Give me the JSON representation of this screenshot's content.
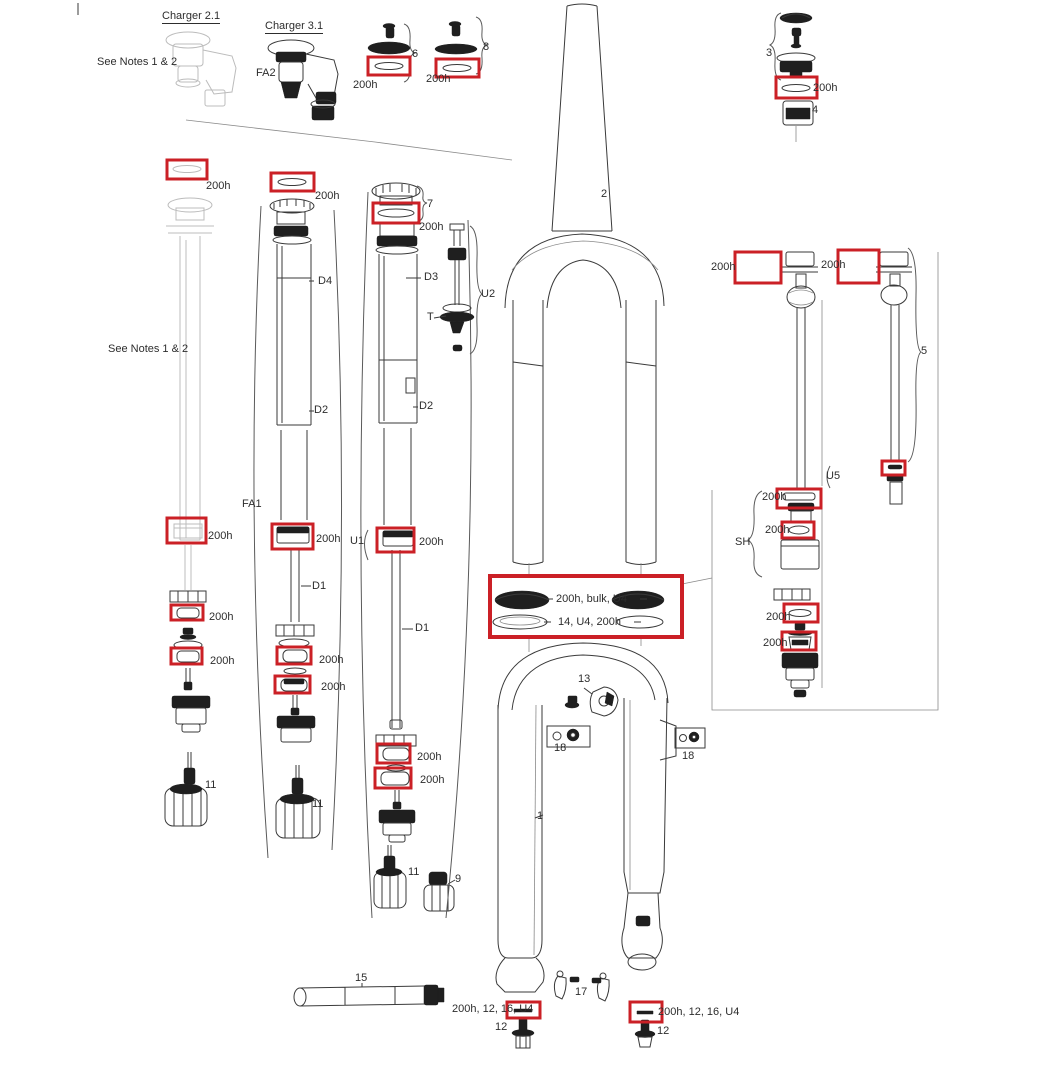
{
  "figure": {
    "type": "exploded-parts-diagram",
    "subject": "Suspension fork exploded parts view",
    "highlight_color": "#cb2026",
    "line_color": "#3a3a3a",
    "ghost_color": "#bcbcbc",
    "annotations": [
      {
        "text": "Charger 2.1",
        "x": 162,
        "y": 10,
        "underline": true
      },
      {
        "text": "Charger 3.1",
        "x": 265,
        "y": 20,
        "underline": true
      },
      {
        "text": "See Notes 1 & 2",
        "x": 97,
        "y": 56
      },
      {
        "text": "FA2",
        "x": 256,
        "y": 67
      },
      {
        "text": "6",
        "x": 412,
        "y": 48
      },
      {
        "text": "200h",
        "x": 353,
        "y": 79
      },
      {
        "text": "8",
        "x": 483,
        "y": 41
      },
      {
        "text": "200h",
        "x": 426,
        "y": 73
      },
      {
        "text": "3",
        "x": 766,
        "y": 47
      },
      {
        "text": "200h",
        "x": 813,
        "y": 82
      },
      {
        "text": "4",
        "x": 812,
        "y": 104
      },
      {
        "text": "200h",
        "x": 206,
        "y": 180
      },
      {
        "text": "200h",
        "x": 315,
        "y": 190
      },
      {
        "text": "7",
        "x": 427,
        "y": 198
      },
      {
        "text": "200h",
        "x": 419,
        "y": 221
      },
      {
        "text": "2",
        "x": 601,
        "y": 188
      },
      {
        "text": "D4",
        "x": 318,
        "y": 275
      },
      {
        "text": "D3",
        "x": 424,
        "y": 271
      },
      {
        "text": "U2",
        "x": 481,
        "y": 288
      },
      {
        "text": "T",
        "x": 427,
        "y": 311
      },
      {
        "text": "200h",
        "x": 711,
        "y": 261
      },
      {
        "text": "200h",
        "x": 821,
        "y": 259
      },
      {
        "text": "5",
        "x": 921,
        "y": 345
      },
      {
        "text": "See Notes 1 & 2",
        "x": 108,
        "y": 343
      },
      {
        "text": "D2",
        "x": 314,
        "y": 404
      },
      {
        "text": "D2",
        "x": 419,
        "y": 400
      },
      {
        "text": "FA1",
        "x": 242,
        "y": 498
      },
      {
        "text": "U5",
        "x": 826,
        "y": 470
      },
      {
        "text": "200h",
        "x": 762,
        "y": 491
      },
      {
        "text": "200h",
        "x": 765,
        "y": 524
      },
      {
        "text": "SH",
        "x": 735,
        "y": 536
      },
      {
        "text": "200h",
        "x": 208,
        "y": 530
      },
      {
        "text": "200h",
        "x": 316,
        "y": 533
      },
      {
        "text": "U1",
        "x": 350,
        "y": 535
      },
      {
        "text": "200h",
        "x": 419,
        "y": 536
      },
      {
        "text": "D1",
        "x": 312,
        "y": 580
      },
      {
        "text": "200h, bulk, U4",
        "x": 556,
        "y": 593
      },
      {
        "text": "14, U4, 200h",
        "x": 558,
        "y": 616
      },
      {
        "text": "D1",
        "x": 415,
        "y": 622
      },
      {
        "text": "200h",
        "x": 766,
        "y": 611
      },
      {
        "text": "200h",
        "x": 763,
        "y": 637
      },
      {
        "text": "200h",
        "x": 209,
        "y": 611
      },
      {
        "text": "200h",
        "x": 210,
        "y": 655
      },
      {
        "text": "200h",
        "x": 319,
        "y": 654
      },
      {
        "text": "200h",
        "x": 321,
        "y": 681
      },
      {
        "text": "13",
        "x": 578,
        "y": 673
      },
      {
        "text": "18",
        "x": 554,
        "y": 742
      },
      {
        "text": "18",
        "x": 682,
        "y": 750
      },
      {
        "text": "200h",
        "x": 417,
        "y": 751
      },
      {
        "text": "200h",
        "x": 420,
        "y": 774
      },
      {
        "text": "11",
        "x": 205,
        "y": 779
      },
      {
        "text": "11",
        "x": 312,
        "y": 798
      },
      {
        "text": "1",
        "x": 537,
        "y": 810
      },
      {
        "text": "11",
        "x": 408,
        "y": 866
      },
      {
        "text": "9",
        "x": 455,
        "y": 873
      },
      {
        "text": "15",
        "x": 355,
        "y": 972
      },
      {
        "text": "17",
        "x": 575,
        "y": 986
      },
      {
        "text": "200h, 12, 16, U4",
        "x": 452,
        "y": 1003
      },
      {
        "text": "12",
        "x": 495,
        "y": 1021
      },
      {
        "text": "200h, 12, 16, U4",
        "x": 658,
        "y": 1006
      },
      {
        "text": "12",
        "x": 657,
        "y": 1025
      }
    ],
    "highlights": [
      {
        "x": 368,
        "y": 57,
        "w": 42,
        "h": 18
      },
      {
        "x": 436,
        "y": 59,
        "w": 43,
        "h": 18
      },
      {
        "x": 776,
        "y": 77,
        "w": 41,
        "h": 21
      },
      {
        "x": 167,
        "y": 160,
        "w": 40,
        "h": 19
      },
      {
        "x": 271,
        "y": 173,
        "w": 43,
        "h": 18
      },
      {
        "x": 373,
        "y": 203,
        "w": 46,
        "h": 20
      },
      {
        "x": 735,
        "y": 252,
        "w": 46,
        "h": 31
      },
      {
        "x": 838,
        "y": 250,
        "w": 41,
        "h": 33
      },
      {
        "x": 882,
        "y": 461,
        "w": 23,
        "h": 14
      },
      {
        "x": 777,
        "y": 489,
        "w": 44,
        "h": 19
      },
      {
        "x": 782,
        "y": 522,
        "w": 32,
        "h": 16
      },
      {
        "x": 784,
        "y": 604,
        "w": 34,
        "h": 18
      },
      {
        "x": 782,
        "y": 632,
        "w": 34,
        "h": 18
      },
      {
        "x": 171,
        "y": 605,
        "w": 32,
        "h": 15
      },
      {
        "x": 171,
        "y": 648,
        "w": 31,
        "h": 16
      },
      {
        "x": 277,
        "y": 647,
        "w": 34,
        "h": 17
      },
      {
        "x": 275,
        "y": 676,
        "w": 35,
        "h": 17
      },
      {
        "x": 377,
        "y": 744,
        "w": 33,
        "h": 19
      },
      {
        "x": 375,
        "y": 768,
        "w": 36,
        "h": 20
      },
      {
        "x": 167,
        "y": 518,
        "w": 39,
        "h": 25
      },
      {
        "x": 272,
        "y": 524,
        "w": 41,
        "h": 25
      },
      {
        "x": 377,
        "y": 528,
        "w": 37,
        "h": 24
      },
      {
        "x": 507,
        "y": 1002,
        "w": 33,
        "h": 16
      },
      {
        "x": 630,
        "y": 1002,
        "w": 32,
        "h": 20
      },
      {
        "x": 490,
        "y": 576,
        "w": 192,
        "h": 61,
        "thick": true
      }
    ]
  }
}
